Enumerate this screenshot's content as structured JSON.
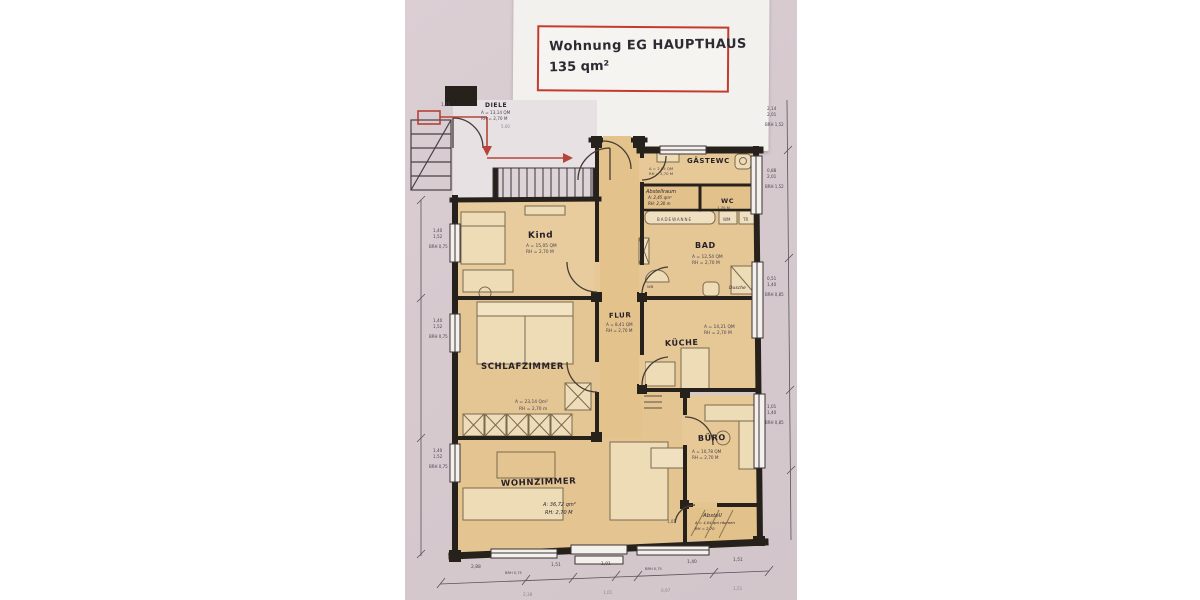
{
  "title_box": {
    "line1": "Wohnung EG HAUPTHAUS",
    "line2": "135 qm²"
  },
  "colors": {
    "accent_red": "#c43b2e",
    "wall": "#27211c",
    "room_fill": "#e5c795",
    "scan_bg": "#d6cacf",
    "paper": "#f3f1ed"
  },
  "rooms": {
    "diele": {
      "name": "DIELE",
      "area": "A = 13,14 QM",
      "height": "RH = 2,70 M"
    },
    "kind": {
      "name": "Kind",
      "area": "A = 15,05 QM",
      "height": "RH = 2,70 M"
    },
    "gaestewc": {
      "name": "GÄSTEWC",
      "area": "A = 2,05 QM",
      "height": "RH = 2,70 M"
    },
    "abstellraum": {
      "name": "Abstellraum",
      "area": "A: 2,45 qm²",
      "height": "RH: 2,30 m"
    },
    "wc": {
      "name": "WC",
      "sub": "1,70 M"
    },
    "bad": {
      "name": "BAD",
      "area": "A = 12,54 QM",
      "height": "RH = 2,70 M",
      "note": "Dusche",
      "sink": "WB"
    },
    "flur": {
      "name": "FLUR",
      "area": "A = 8,41 QM",
      "height": "RH = 2,70 M"
    },
    "kueche": {
      "name": "KÜCHE",
      "area": "A = 14,21 QM",
      "height": "RH = 2,70 M"
    },
    "schlafzimmer": {
      "name": "SCHLAFZIMMER",
      "area": "A = 23,14 Qm²",
      "height": "RH = 2,70 m"
    },
    "buero": {
      "name": "BÜRO",
      "area": "A = 10,78 QM",
      "height": "RH = 2,70 M"
    },
    "wohnzimmer": {
      "name": "WOHNZIMMER",
      "area": "A: 36,72 qm²",
      "height": "RH: 2,70 M"
    },
    "abstell": {
      "name": "Abstell",
      "area": "A = 4,04 qm räumen",
      "height": "RH = 2,70"
    }
  },
  "fixtures": {
    "bathtub": "BADEWANNE",
    "washer": "WM",
    "dryer": "TR"
  },
  "dims": {
    "left": [
      {
        "size": "1,40",
        "size2": "1,52",
        "brh": "BRH 0,75"
      },
      {
        "size": "1,40",
        "size2": "1,52",
        "brh": "BRH 0,75"
      },
      {
        "size": "1,40",
        "size2": "1,52",
        "brh": "BRH 0,75"
      }
    ],
    "right": [
      {
        "size": "2,14",
        "size2": "2,01",
        "brh": "BRH 1,52"
      },
      {
        "size": "0,88",
        "size2": "2,01",
        "brh": "BRH 1,52"
      },
      {
        "size": "0,51",
        "size2": "1,40",
        "brh": "BRH 0,85"
      },
      {
        "size": "1,01",
        "size2": "1,40",
        "brh": "BRH 0,85"
      }
    ],
    "bottom": [
      "2,88",
      "BRH 0,75",
      "1,51",
      "1,01",
      "BRH 0,75",
      "1,40",
      "1,51"
    ],
    "bottom2": [
      "2,38",
      "1,01",
      "0,97",
      "1,51"
    ],
    "misc": {
      "door_width": "1,11",
      "corridor": "5,00",
      "entry": "1,01"
    }
  }
}
